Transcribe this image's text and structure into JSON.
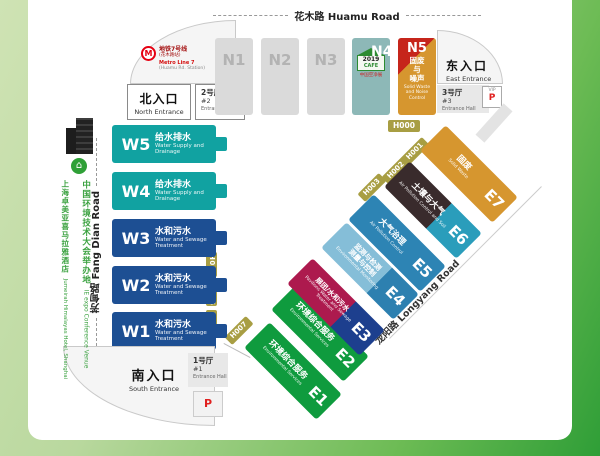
{
  "colors": {
    "page_green_light": "#cfe3b4",
    "page_green_dark": "#2f9e37",
    "hall_gray": "#dadada",
    "hall_teal": "#11a2a1",
    "hall_navy": "#1d4f93",
    "hall_green": "#0f9b3e",
    "hall_crimson": "#ad1a4e",
    "hall_lightblue": "#85bed8",
    "hall_blue": "#2d84b4",
    "hall_darkbrown": "#392b2c",
    "hall_cyan": "#2a9dbb",
    "hall_orange": "#d6962f",
    "n5_red": "#c6251b",
    "n4_teal": "#8db8b7",
    "aisle_gold": "#a89e43",
    "metro_red": "#e60012",
    "parking_red": "#e0201f",
    "hotel_green": "#3aa13f"
  },
  "roads": {
    "huamu": "花木路 Huamu Road",
    "fangdian": "芳甸路 Fang Dian Road",
    "longyang": "龙阳路 Longyang Road"
  },
  "metro": {
    "logo": "M",
    "line_cn": "地铁7号线",
    "station_cn": "(花木路站)",
    "line_en": "Metro Line 7",
    "station_en": "(Huamu Rd. Station)"
  },
  "entrances": {
    "north_cn": "北入口",
    "north_en": "North Entrance",
    "east_cn": "东入口",
    "east_en": "East Entrance",
    "south_cn": "南入口",
    "south_en": "South Entrance"
  },
  "entrance_halls": {
    "hall2_cn": "2号厅",
    "hall2_num": "#2",
    "hall2_en": "Entrance Hall",
    "hall3_cn": "3号厅",
    "hall3_num": "#3",
    "hall3_en": "Entrance Hall",
    "hall1_cn": "1号厅",
    "hall1_num": "#1",
    "hall1_en": "Entrance Hall"
  },
  "parking": {
    "vip_label": "VIP",
    "p_label": "P"
  },
  "cafe_logo": {
    "year": "2019",
    "name": "CAFE",
    "cn": "中国空净展"
  },
  "halls": {
    "n1": "N1",
    "n2": "N2",
    "n3": "N3",
    "n4": "N4",
    "n5_id": "N5",
    "n5_cn1": "固废",
    "n5_cn2": "与",
    "n5_cn3": "噪声",
    "n5_en": "Solid Waste and Noise Control",
    "w5_id": "W5",
    "w5_cn": "给水排水",
    "w5_en": "Water Supply and Drainage",
    "w4_id": "W4",
    "w4_cn": "给水排水",
    "w4_en": "Water Supply and Drainage",
    "w3_id": "W3",
    "w3_cn": "水和污水",
    "w3_en": "Water and Sewage Treatment",
    "w2_id": "W2",
    "w2_cn": "水和污水",
    "w2_en": "Water and Sewage Treatment",
    "w1_id": "W1",
    "w1_cn": "水和污水",
    "w1_en": "Water and Sewage Treatment",
    "e1_id": "E1",
    "e1_cn": "环境综合服务",
    "e1_en": "Environmental Services",
    "e2_id": "E2",
    "e2_cn": "环境综合服务",
    "e2_en": "Environmental Services",
    "e3_id": "E3",
    "e3_cn": "展团/水和污水",
    "e3_en": "Pavilions Water and Sewage Treatment",
    "e4_id": "E4",
    "e4_cn1": "监测与检测",
    "e4_cn2": "测量与控制",
    "e4_en": "Environmental Monitoring",
    "e5_id": "E5",
    "e5_cn": "大气治理",
    "e5_en": "Air Pollution Control",
    "e6_id": "E6",
    "e6_cn": "土壤与大气",
    "e6_en": "Air Pollution Control and Soil",
    "e7_id": "E7",
    "e7_cn": "固废",
    "e7_en": "Solid Waste"
  },
  "aisles": {
    "h000": "H000",
    "h001": "H001",
    "h002": "H002",
    "h003": "H003",
    "h004": "H004",
    "h005": "H005",
    "h006": "H006",
    "h007": "H007"
  },
  "venue_note": {
    "cn1": "中国环境技术大会举办地",
    "en1": " IE expo Conference Venue",
    "cn2": "上海卓美亚喜马拉雅酒店",
    "en2": " Jumeirah Himalayas Hotel, Shanghai"
  },
  "hotel_pin_glyph": "⌂"
}
